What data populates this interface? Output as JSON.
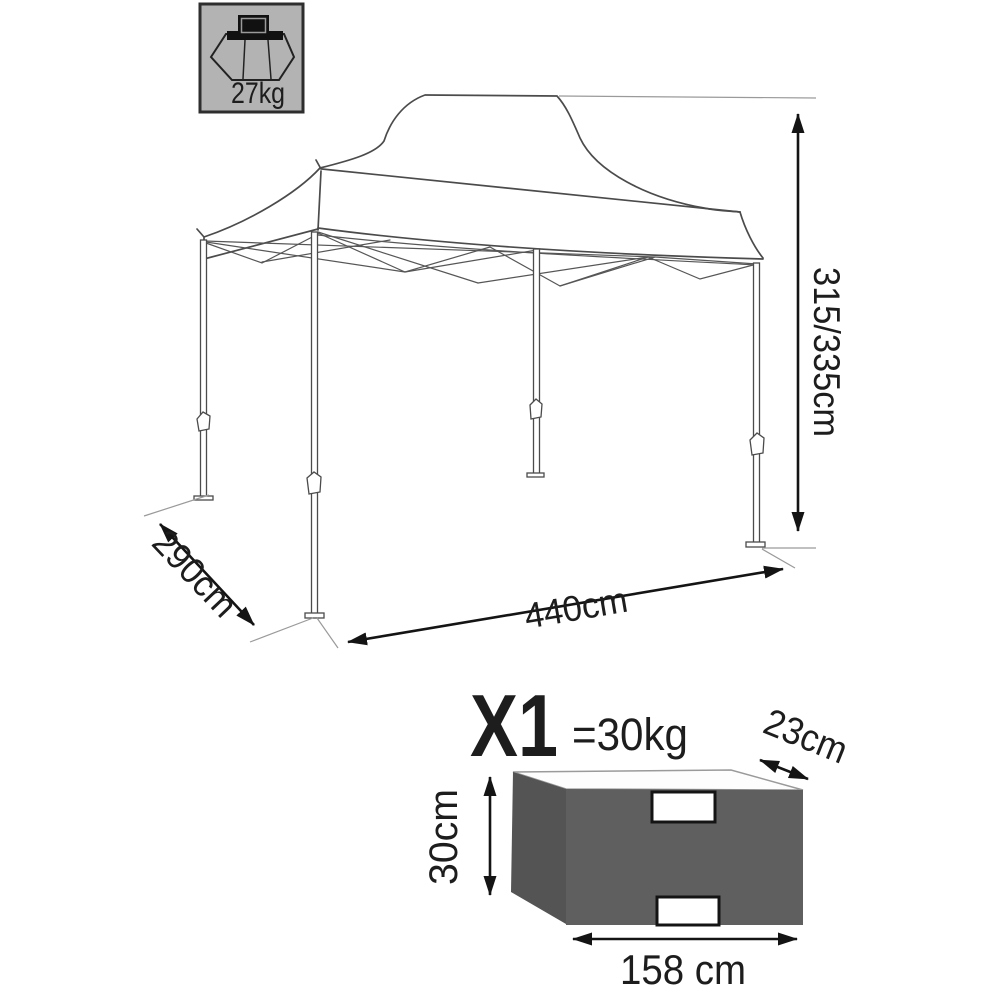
{
  "badge": {
    "weight_label": "27kg"
  },
  "gazebo_dimensions": {
    "height_label": "315/335cm",
    "depth_label": "290cm",
    "width_label": "440cm"
  },
  "package": {
    "quantity_label": "X1",
    "weight_label": "=30kg",
    "depth_label": "23cm",
    "height_label": "30cm",
    "width_label": "158 cm"
  },
  "colors": {
    "badge_bg": "#b3b3b3",
    "box_front": "#5f5f5f",
    "box_side": "#545454",
    "box_top": "#fdfdfd"
  }
}
